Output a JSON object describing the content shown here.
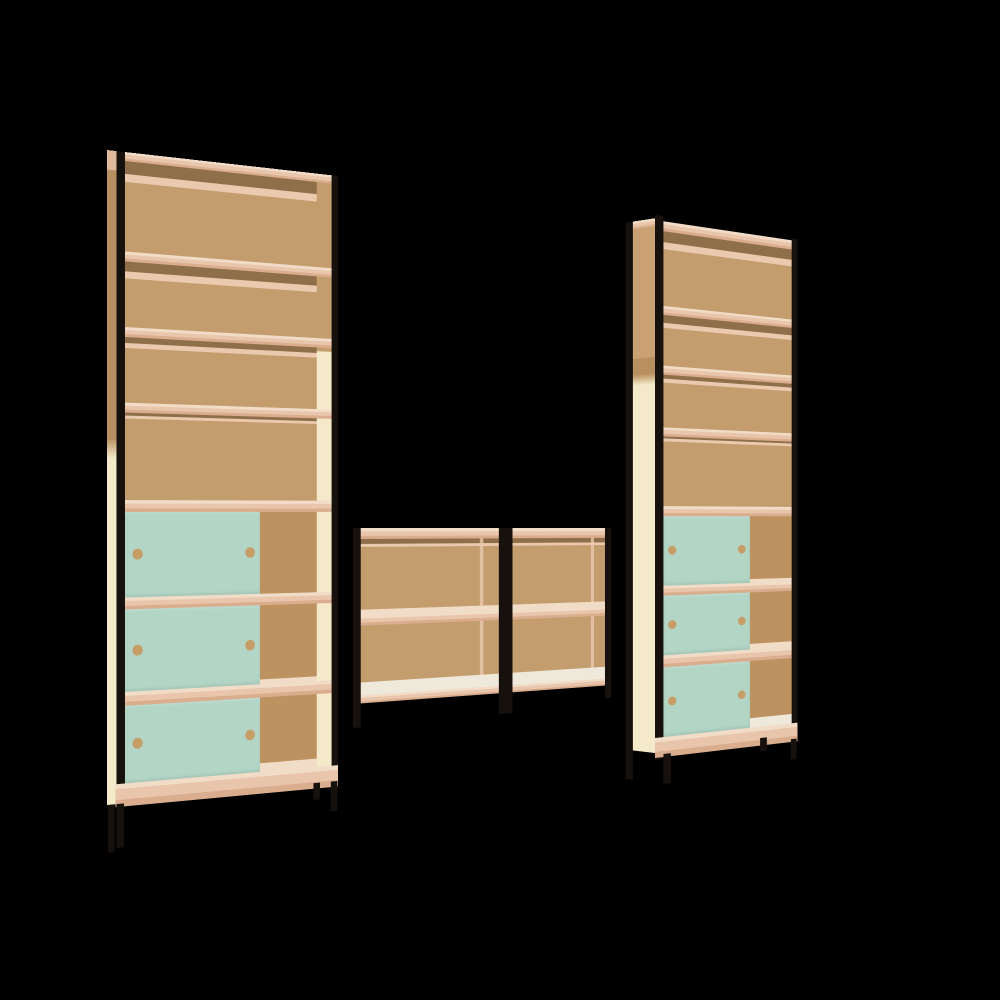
{
  "scene": {
    "description": "3D product render of a modular shelving wall: two tall bookcase towers joined by a floating two-row bridge shelf, on a black background",
    "background": "#000000"
  },
  "colors": {
    "bg": "#000000",
    "frame": "#17110d",
    "back": "#c49d6e",
    "back_deep": "#bb9260",
    "shelf_top": "#f1dcc7",
    "shelf": "#e9c6ab",
    "shelf_deep": "#d9ad8e",
    "shadow": "#8f6f49",
    "pinkline": "#eac9ae",
    "cream": "#f4e9c9",
    "mint": "#b2d5c5",
    "hole": "#c69d66",
    "floor": "#efe9dc"
  },
  "units": {
    "left_tower": {
      "name": "left tall bookcase",
      "shelf_rows": 7,
      "open_rows": 4,
      "door_rows": 3,
      "sliding_doors": 3,
      "door_color": "#b2d5c5",
      "handle_holes_per_door": 2,
      "frame": "black steel rails and legs"
    },
    "bridge": {
      "name": "floating bridge shelves",
      "sections": 2,
      "shelf_rows_per_section": 2,
      "frame": "black steel rails"
    },
    "right_tower": {
      "name": "right tall bookcase",
      "shelf_rows": 7,
      "open_rows": 4,
      "door_rows": 3,
      "sliding_doors": 3,
      "door_color": "#b2d5c5",
      "handle_holes_per_door": 2,
      "frame": "black steel rails and legs"
    }
  }
}
